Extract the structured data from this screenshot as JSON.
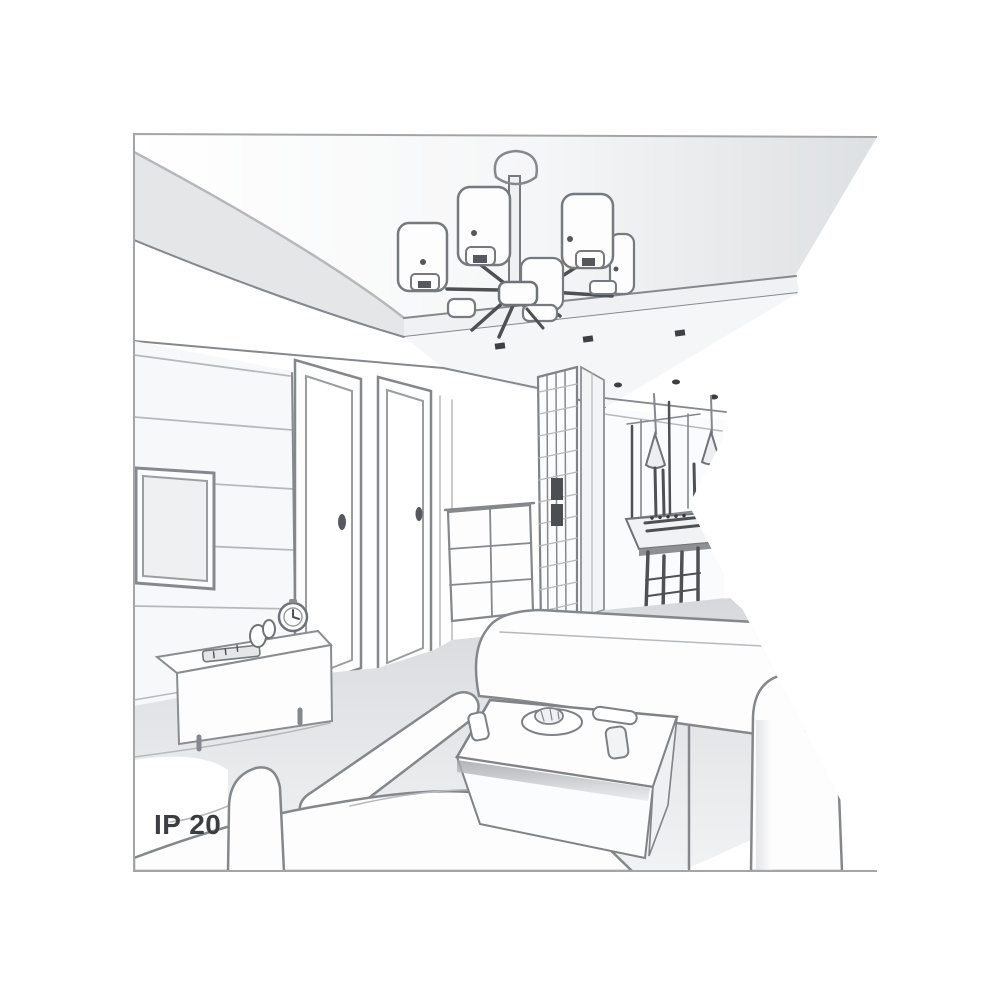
{
  "illustration": {
    "label": "IP 20",
    "scene": "living-room-interior-line-drawing",
    "elements": [
      "ceiling-chandelier-six-cylinder-shades",
      "recessed-ceiling-spotlights",
      "plank-tv-wall-panel",
      "wall-mounted-tv",
      "tv-sideboard-with-remote-clock-figurine",
      "interior-door-left",
      "interior-door-right",
      "chest-of-drawers",
      "lattice-wardrobe",
      "hallway-to-dining-area",
      "window",
      "cone-pendant-lamps",
      "dining-table-with-chairs",
      "corner-sofa-with-chaise",
      "right-sofa",
      "coffee-table-with-plate-tray-cups"
    ],
    "colors": {
      "background": "#ffffff",
      "line": "#85888c",
      "line_dark": "#4e5154",
      "line_light": "#b6b9bc",
      "shade_light": "#e8eaec",
      "floor": "#dfe1e4",
      "label_text": "#3b3d40",
      "frame_border": "#a3a6a9"
    }
  }
}
